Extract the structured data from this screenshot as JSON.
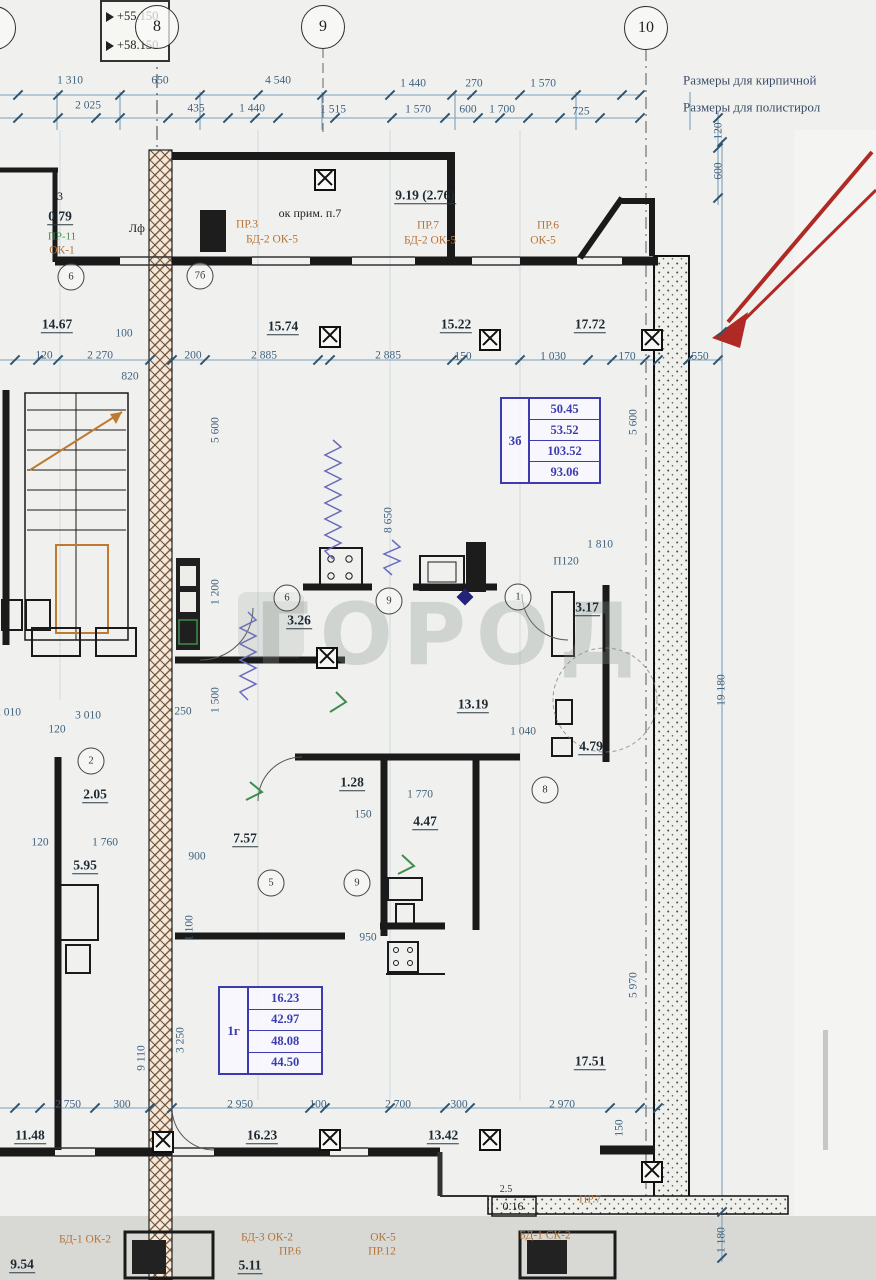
{
  "title": "План этажа — фрагмент в осях 7-10",
  "watermark": "ГОРОД",
  "colors": {
    "dim_text": "#3f6280",
    "area_text": "#1d2a33",
    "stamp_blue": "#3c3cb0",
    "label_orange": "#b5743a",
    "label_green": "#3e8e4e",
    "arrow_red": "#b02a25",
    "wall_dark": "#1a1a1a",
    "hatch_brown": "#8a5a30"
  },
  "elevation_marks": {
    "top": "+55.150",
    "bottom": "+58.150"
  },
  "axis_bubbles": [
    {
      "label": "7",
      "x": -6,
      "y": 28
    },
    {
      "label": "8",
      "x": 157,
      "y": 27
    },
    {
      "label": "9",
      "x": 323,
      "y": 27
    },
    {
      "label": "10",
      "x": 646,
      "y": 28
    }
  ],
  "stamps": [
    {
      "unit": "3б",
      "rows": [
        "50.45",
        "53.52",
        "103.52",
        "93.06"
      ],
      "x": 500,
      "y": 397,
      "w": 97,
      "h": 83
    },
    {
      "unit": "1г",
      "rows": [
        "16.23",
        "42.97",
        "48.08",
        "44.50"
      ],
      "x": 218,
      "y": 986,
      "w": 101,
      "h": 85
    }
  ],
  "annotations": [
    {
      "t": "Размеры для кирпичной",
      "x": 683,
      "y": 80,
      "c": "n"
    },
    {
      "t": "Размеры для полистирол",
      "x": 683,
      "y": 107,
      "c": "n"
    },
    {
      "t": "1 310",
      "x": 70,
      "y": 81,
      "c": "d"
    },
    {
      "t": "650",
      "x": 160,
      "y": 81,
      "c": "d"
    },
    {
      "t": "4 540",
      "x": 278,
      "y": 81,
      "c": "d"
    },
    {
      "t": "1 440",
      "x": 413,
      "y": 84,
      "c": "d"
    },
    {
      "t": "270",
      "x": 474,
      "y": 84,
      "c": "d"
    },
    {
      "t": "1 570",
      "x": 543,
      "y": 84,
      "c": "d"
    },
    {
      "t": "2 025",
      "x": 88,
      "y": 106,
      "c": "d"
    },
    {
      "t": "435",
      "x": 196,
      "y": 109,
      "c": "d"
    },
    {
      "t": "1 440",
      "x": 252,
      "y": 109,
      "c": "d"
    },
    {
      "t": "1 515",
      "x": 333,
      "y": 110,
      "c": "d"
    },
    {
      "t": "1 570",
      "x": 418,
      "y": 110,
      "c": "d"
    },
    {
      "t": "600",
      "x": 468,
      "y": 110,
      "c": "d"
    },
    {
      "t": "1 700",
      "x": 502,
      "y": 110,
      "c": "d"
    },
    {
      "t": "725",
      "x": 581,
      "y": 112,
      "c": "d"
    },
    {
      "t": "120",
      "x": 719,
      "y": 131,
      "c": "d",
      "r": 1
    },
    {
      "t": "600",
      "x": 719,
      "y": 171,
      "c": "d",
      "r": 1
    },
    {
      "t": "120",
      "x": 44,
      "y": 356,
      "c": "d"
    },
    {
      "t": "2 270",
      "x": 100,
      "y": 356,
      "c": "d"
    },
    {
      "t": "200",
      "x": 193,
      "y": 356,
      "c": "d"
    },
    {
      "t": "2 885",
      "x": 264,
      "y": 356,
      "c": "d"
    },
    {
      "t": "2 885",
      "x": 388,
      "y": 356,
      "c": "d"
    },
    {
      "t": "150",
      "x": 463,
      "y": 357,
      "c": "d"
    },
    {
      "t": "1 030",
      "x": 553,
      "y": 357,
      "c": "d"
    },
    {
      "t": "170",
      "x": 627,
      "y": 357,
      "c": "d"
    },
    {
      "t": "550",
      "x": 700,
      "y": 357,
      "c": "d"
    },
    {
      "t": "100",
      "x": 124,
      "y": 334,
      "c": "d"
    },
    {
      "t": "820",
      "x": 130,
      "y": 377,
      "c": "d"
    },
    {
      "t": "14.67",
      "x": 57,
      "y": 325,
      "c": "a"
    },
    {
      "t": "15.74",
      "x": 283,
      "y": 327,
      "c": "a"
    },
    {
      "t": "15.22",
      "x": 456,
      "y": 325,
      "c": "a"
    },
    {
      "t": "17.72",
      "x": 590,
      "y": 325,
      "c": "a"
    },
    {
      "t": "9.19 (2.76)",
      "x": 425,
      "y": 196,
      "c": "a"
    },
    {
      "t": "ок прим. п.7",
      "x": 310,
      "y": 213,
      "c": "k"
    },
    {
      "t": "3",
      "x": 60,
      "y": 196,
      "c": "k"
    },
    {
      "t": "0.79",
      "x": 60,
      "y": 217,
      "c": "a"
    },
    {
      "t": "Лф",
      "x": 137,
      "y": 228,
      "c": "k"
    },
    {
      "t": "ПР-11",
      "x": 62,
      "y": 237,
      "c": "g"
    },
    {
      "t": "ОК-1",
      "x": 62,
      "y": 251,
      "c": "o"
    },
    {
      "t": "ПР.3",
      "x": 247,
      "y": 225,
      "c": "o"
    },
    {
      "t": "БД-2 ОК-5",
      "x": 272,
      "y": 240,
      "c": "o"
    },
    {
      "t": "ПР.7",
      "x": 428,
      "y": 226,
      "c": "o"
    },
    {
      "t": "БД-2 ОК-5",
      "x": 430,
      "y": 241,
      "c": "o"
    },
    {
      "t": "ПР.6",
      "x": 548,
      "y": 226,
      "c": "o"
    },
    {
      "t": "ОК-5",
      "x": 543,
      "y": 241,
      "c": "o"
    },
    {
      "t": "5 600",
      "x": 216,
      "y": 430,
      "c": "d",
      "r": 1
    },
    {
      "t": "5 600",
      "x": 634,
      "y": 422,
      "c": "d",
      "r": 1
    },
    {
      "t": "8 650",
      "x": 389,
      "y": 520,
      "c": "d",
      "r": 1
    },
    {
      "t": "1 200",
      "x": 216,
      "y": 592,
      "c": "d",
      "r": 1
    },
    {
      "t": "1 500",
      "x": 216,
      "y": 700,
      "c": "d",
      "r": 1
    },
    {
      "t": "3.26",
      "x": 299,
      "y": 621,
      "c": "a"
    },
    {
      "t": "1 810",
      "x": 600,
      "y": 545,
      "c": "d"
    },
    {
      "t": "П120",
      "x": 566,
      "y": 562,
      "c": "d"
    },
    {
      "t": "3.17",
      "x": 587,
      "y": 608,
      "c": "a"
    },
    {
      "t": "13.19",
      "x": 473,
      "y": 705,
      "c": "a"
    },
    {
      "t": "1 040",
      "x": 523,
      "y": 732,
      "c": "d"
    },
    {
      "t": "4.79",
      "x": 591,
      "y": 747,
      "c": "a"
    },
    {
      "t": "2 010",
      "x": 8,
      "y": 713,
      "c": "d"
    },
    {
      "t": "3 010",
      "x": 88,
      "y": 716,
      "c": "d"
    },
    {
      "t": "120",
      "x": 57,
      "y": 730,
      "c": "d"
    },
    {
      "t": "250",
      "x": 183,
      "y": 712,
      "c": "d"
    },
    {
      "t": "2.05",
      "x": 95,
      "y": 795,
      "c": "a"
    },
    {
      "t": "5.95",
      "x": 85,
      "y": 866,
      "c": "a"
    },
    {
      "t": "120",
      "x": 40,
      "y": 843,
      "c": "d"
    },
    {
      "t": "1 760",
      "x": 105,
      "y": 843,
      "c": "d"
    },
    {
      "t": "7.57",
      "x": 245,
      "y": 839,
      "c": "a"
    },
    {
      "t": "1.28",
      "x": 352,
      "y": 783,
      "c": "a"
    },
    {
      "t": "1 770",
      "x": 420,
      "y": 795,
      "c": "d"
    },
    {
      "t": "150",
      "x": 363,
      "y": 815,
      "c": "d"
    },
    {
      "t": "4.47",
      "x": 425,
      "y": 822,
      "c": "a"
    },
    {
      "t": "900",
      "x": 197,
      "y": 857,
      "c": "d"
    },
    {
      "t": "950",
      "x": 368,
      "y": 938,
      "c": "d"
    },
    {
      "t": "1 100",
      "x": 190,
      "y": 928,
      "c": "d",
      "r": 1
    },
    {
      "t": "3 250",
      "x": 181,
      "y": 1040,
      "c": "d",
      "r": 1
    },
    {
      "t": "9 110",
      "x": 142,
      "y": 1058,
      "c": "d",
      "r": 1
    },
    {
      "t": "19 180",
      "x": 722,
      "y": 690,
      "c": "d",
      "r": 1
    },
    {
      "t": "5 970",
      "x": 634,
      "y": 985,
      "c": "d",
      "r": 1
    },
    {
      "t": "17.51",
      "x": 590,
      "y": 1062,
      "c": "a"
    },
    {
      "t": "2 750",
      "x": 68,
      "y": 1105,
      "c": "d"
    },
    {
      "t": "300",
      "x": 122,
      "y": 1105,
      "c": "d"
    },
    {
      "t": "2 950",
      "x": 240,
      "y": 1105,
      "c": "d"
    },
    {
      "t": "100",
      "x": 318,
      "y": 1105,
      "c": "d"
    },
    {
      "t": "2 700",
      "x": 398,
      "y": 1105,
      "c": "d"
    },
    {
      "t": "300",
      "x": 459,
      "y": 1105,
      "c": "d"
    },
    {
      "t": "2 970",
      "x": 562,
      "y": 1105,
      "c": "d"
    },
    {
      "t": "150",
      "x": 620,
      "y": 1128,
      "c": "d",
      "r": 1
    },
    {
      "t": "11.48",
      "x": 30,
      "y": 1136,
      "c": "a"
    },
    {
      "t": "16.23",
      "x": 262,
      "y": 1136,
      "c": "a"
    },
    {
      "t": "13.42",
      "x": 443,
      "y": 1136,
      "c": "a"
    },
    {
      "t": "2.5",
      "x": 506,
      "y": 1190,
      "c": "s"
    },
    {
      "t": "0.16",
      "x": 513,
      "y": 1206,
      "c": "k"
    },
    {
      "t": "ПР.7",
      "x": 590,
      "y": 1200,
      "c": "o"
    },
    {
      "t": "БД-1 СК-2",
      "x": 545,
      "y": 1236,
      "c": "o"
    },
    {
      "t": "БД-1 ОК-2",
      "x": 85,
      "y": 1240,
      "c": "o"
    },
    {
      "t": "БД-3 ОК-2",
      "x": 267,
      "y": 1238,
      "c": "o"
    },
    {
      "t": "ПР.6",
      "x": 290,
      "y": 1252,
      "c": "o"
    },
    {
      "t": "ОК-5",
      "x": 383,
      "y": 1238,
      "c": "o"
    },
    {
      "t": "ПР.12",
      "x": 382,
      "y": 1252,
      "c": "o"
    },
    {
      "t": "9.54",
      "x": 22,
      "y": 1265,
      "c": "a"
    },
    {
      "t": "5.11",
      "x": 250,
      "y": 1266,
      "c": "a"
    },
    {
      "t": "1 180",
      "x": 722,
      "y": 1240,
      "c": "d",
      "r": 1
    }
  ],
  "fixture_circles": [
    {
      "n": "6",
      "x": 71,
      "y": 277
    },
    {
      "n": "7б",
      "x": 200,
      "y": 276
    },
    {
      "n": "6",
      "x": 287,
      "y": 598
    },
    {
      "n": "9",
      "x": 389,
      "y": 601
    },
    {
      "n": "1",
      "x": 518,
      "y": 597
    },
    {
      "n": "2",
      "x": 91,
      "y": 761
    },
    {
      "n": "5",
      "x": 271,
      "y": 883
    },
    {
      "n": "9",
      "x": 357,
      "y": 883
    },
    {
      "n": "8",
      "x": 545,
      "y": 790
    }
  ],
  "columns": [
    {
      "x": 325,
      "y": 180
    },
    {
      "x": 330,
      "y": 337
    },
    {
      "x": 490,
      "y": 340
    },
    {
      "x": 652,
      "y": 340
    },
    {
      "x": 327,
      "y": 658
    },
    {
      "x": 163,
      "y": 1142
    },
    {
      "x": 330,
      "y": 1140
    },
    {
      "x": 490,
      "y": 1140
    },
    {
      "x": 652,
      "y": 1172
    }
  ],
  "ticks": [
    [
      18,
      95
    ],
    [
      58,
      95
    ],
    [
      120,
      95
    ],
    [
      200,
      95
    ],
    [
      258,
      95
    ],
    [
      322,
      95
    ],
    [
      390,
      95
    ],
    [
      452,
      95
    ],
    [
      472,
      95
    ],
    [
      520,
      95
    ],
    [
      576,
      95
    ],
    [
      622,
      95
    ],
    [
      640,
      95
    ],
    [
      18,
      118
    ],
    [
      58,
      118
    ],
    [
      96,
      118
    ],
    [
      120,
      118
    ],
    [
      168,
      118
    ],
    [
      200,
      118
    ],
    [
      228,
      118
    ],
    [
      255,
      118
    ],
    [
      278,
      118
    ],
    [
      335,
      118
    ],
    [
      392,
      118
    ],
    [
      445,
      118
    ],
    [
      478,
      118
    ],
    [
      500,
      118
    ],
    [
      528,
      118
    ],
    [
      560,
      118
    ],
    [
      600,
      118
    ],
    [
      640,
      118
    ],
    [
      718,
      118
    ],
    [
      718,
      148
    ],
    [
      718,
      198
    ],
    [
      15,
      360
    ],
    [
      38,
      360
    ],
    [
      58,
      360
    ],
    [
      150,
      360
    ],
    [
      172,
      360
    ],
    [
      205,
      360
    ],
    [
      318,
      360
    ],
    [
      330,
      360
    ],
    [
      452,
      360
    ],
    [
      462,
      360
    ],
    [
      520,
      360
    ],
    [
      588,
      360
    ],
    [
      612,
      360
    ],
    [
      645,
      360
    ],
    [
      658,
      360
    ],
    [
      688,
      360
    ],
    [
      718,
      360
    ],
    [
      15,
      1108
    ],
    [
      40,
      1108
    ],
    [
      95,
      1108
    ],
    [
      150,
      1108
    ],
    [
      172,
      1108
    ],
    [
      310,
      1108
    ],
    [
      325,
      1108
    ],
    [
      390,
      1108
    ],
    [
      445,
      1108
    ],
    [
      470,
      1108
    ],
    [
      610,
      1108
    ],
    [
      640,
      1108
    ],
    [
      658,
      1108
    ],
    [
      722,
      142
    ],
    [
      722,
      332
    ],
    [
      722,
      1212
    ],
    [
      722,
      1258
    ]
  ]
}
